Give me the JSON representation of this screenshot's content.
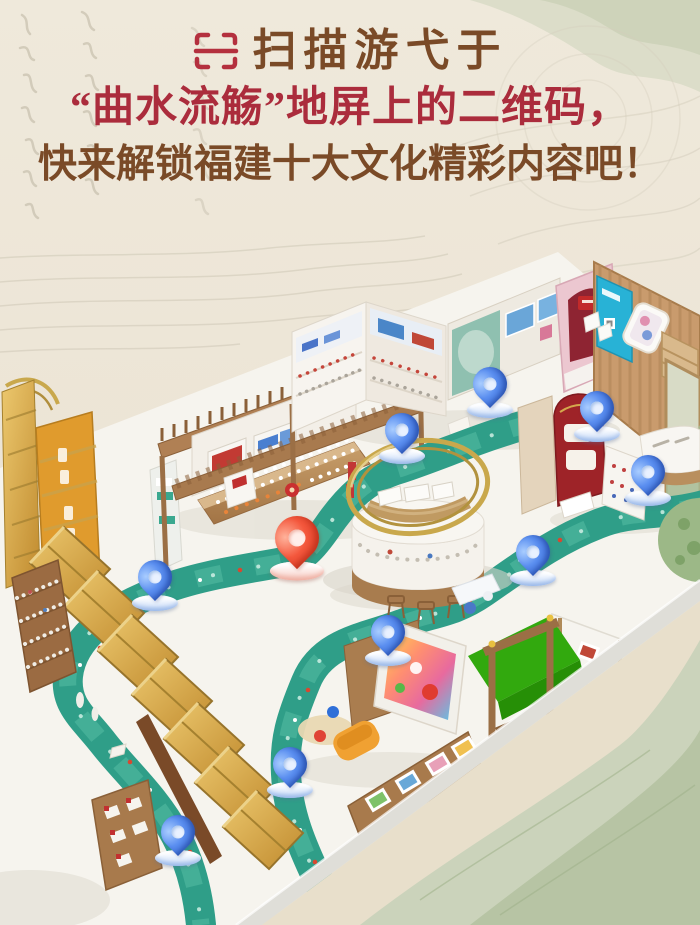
{
  "header": {
    "scan_icon": "qr-scan-frame",
    "line1": "扫描游弋于",
    "line2": "“曲水流觞”地屏上的二维码，",
    "line3": "快来解锁福建十大文化精彩内容吧！"
  },
  "colors": {
    "accent-red": "#ab2c3c",
    "text-brown": "#7a4a27",
    "icon-red": "#b4303e",
    "river-teal": "#2f9e88",
    "pin-blue": "#4b82e8",
    "pin-red": "#f2503a",
    "chroma-green": "#32a90e",
    "gold": "#c9a84c",
    "bg-beige": "#ece4d6"
  },
  "scene": {
    "pins": [
      {
        "color": "blue",
        "x": 402,
        "y": 456
      },
      {
        "color": "blue",
        "x": 490,
        "y": 410
      },
      {
        "color": "blue",
        "x": 597,
        "y": 434
      },
      {
        "color": "blue",
        "x": 648,
        "y": 498
      },
      {
        "color": "blue",
        "x": 533,
        "y": 578
      },
      {
        "color": "blue",
        "x": 155,
        "y": 603
      },
      {
        "color": "blue",
        "x": 388,
        "y": 658
      },
      {
        "color": "blue",
        "x": 290,
        "y": 790
      },
      {
        "color": "blue",
        "x": 178,
        "y": 858
      },
      {
        "color": "red",
        "x": 297,
        "y": 571
      }
    ]
  }
}
